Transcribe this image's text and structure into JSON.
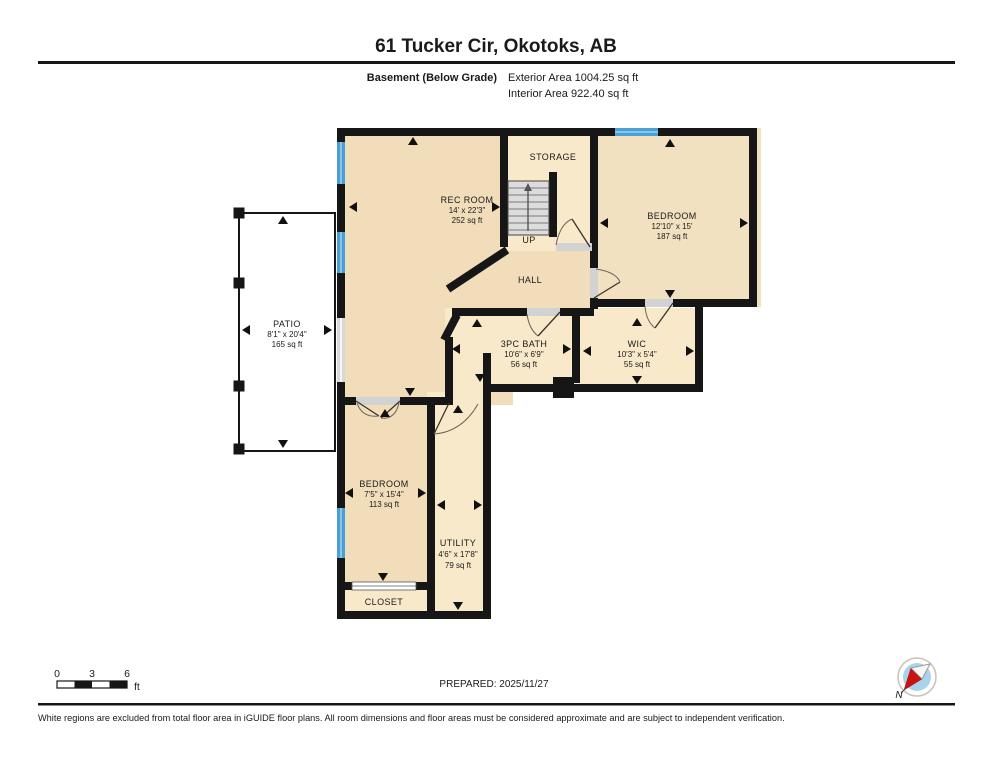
{
  "header": {
    "title": "61 Tucker Cir, Okotoks, AB",
    "floor_label": "Basement (Below Grade)",
    "exterior_area": "Exterior Area 1004.25 sq ft",
    "interior_area": "Interior Area 922.40 sq ft"
  },
  "rooms": {
    "rec": {
      "name": "REC ROOM",
      "dim": "14' x 22'3\"",
      "area": "252 sq ft"
    },
    "storage": {
      "name": "STORAGE"
    },
    "stairs_up": {
      "label": "UP"
    },
    "hall": {
      "name": "HALL"
    },
    "bedroom_main": {
      "name": "BEDROOM",
      "dim": "12'10\" x 15'",
      "area": "187 sq ft"
    },
    "patio": {
      "name": "PATIO",
      "dim": "8'1\" x 20'4\"",
      "area": "165 sq ft"
    },
    "bath": {
      "name": "3PC BATH",
      "dim": "10'6\" x 6'9\"",
      "area": "56 sq ft"
    },
    "wic": {
      "name": "WIC",
      "dim": "10'3\" x 5'4\"",
      "area": "55 sq ft"
    },
    "bedroom_second": {
      "name": "BEDROOM",
      "dim": "7'5\" x 15'4\"",
      "area": "113 sq ft"
    },
    "utility": {
      "name": "UTILITY",
      "dim": "4'6\" x 17'8\"",
      "area": "79 sq ft"
    },
    "closet": {
      "name": "CLOSET"
    }
  },
  "footer": {
    "prepared": "PREPARED: 2025/11/27",
    "disclaimer": "White regions are excluded from total floor area in iGUIDE floor plans. All room dimensions and floor areas must be considered approximate and are subject to independent verification.",
    "scale": {
      "start": "0",
      "mid": "3",
      "end": "6",
      "unit": "ft"
    },
    "compass_north": "N"
  },
  "colors": {
    "wall": "#161616",
    "room_tan": "#f1ddb9",
    "room_tan2": "#f2e1c1",
    "room_light": "#f8e9ca",
    "window_blue": "#4aa0d6",
    "window_highlight": "#8cc6e6",
    "door_gray": "#d2d2d2",
    "stairs_gray": "#dcdcdc",
    "compass_disc": "#a9d2ec",
    "compass_needle_red": "#cc1111"
  }
}
